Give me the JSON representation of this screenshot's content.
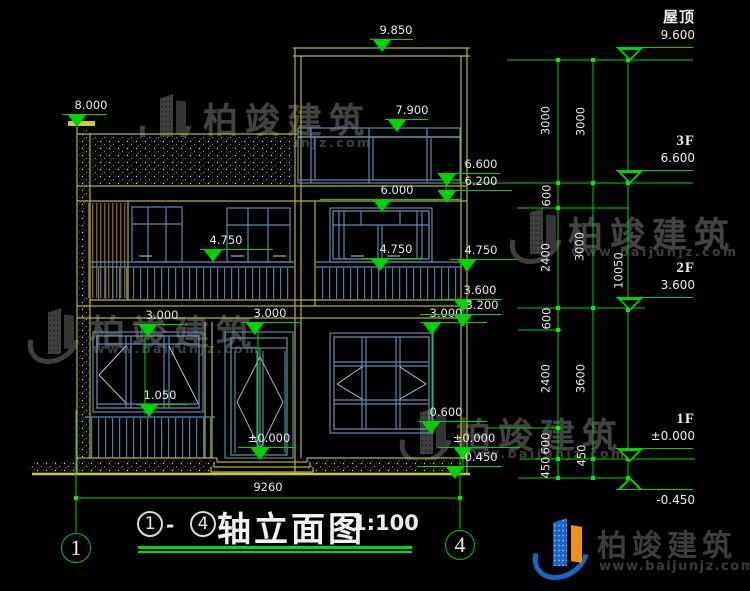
{
  "watermark": {
    "brand": "柏竣建筑",
    "url": "www.baijunjz.com"
  },
  "footer_logo": {
    "brand": "柏竣建筑",
    "url": "www.baijunjz.com"
  },
  "title": {
    "axis_start": "1",
    "dash": "-",
    "axis_end": "4",
    "name": "轴立面图",
    "scale": "1:100"
  },
  "axis_bubbles": [
    {
      "label": "1",
      "x": 76,
      "y": 548
    },
    {
      "label": "4",
      "x": 460,
      "y": 545
    }
  ],
  "width_dim": {
    "value": "9260",
    "x": 268,
    "y": 488
  },
  "elevation_marks": [
    {
      "value": "8.000",
      "tx": 91,
      "x1": 62,
      "x2": 107,
      "ly": 114,
      "mx": 77
    },
    {
      "value": "9.850",
      "tx": 396,
      "x1": 370,
      "x2": 413,
      "ly": 39,
      "mx": 382
    },
    {
      "value": "7.900",
      "tx": 412,
      "x1": 385,
      "x2": 428,
      "ly": 119,
      "mx": 397
    },
    {
      "value": "6.000",
      "tx": 397,
      "x1": 320,
      "x2": 462,
      "ly": 199,
      "mx": 382
    },
    {
      "value": "4.750",
      "tx": 226,
      "x1": 200,
      "x2": 273,
      "ly": 249,
      "mx": 213
    },
    {
      "value": "4.750",
      "tx": 396,
      "x1": 362,
      "x2": 422,
      "ly": 258,
      "mx": 380
    },
    {
      "value": "3.000",
      "tx": 162,
      "x1": 133,
      "x2": 187,
      "ly": 324,
      "mx": 148
    },
    {
      "value": "3.000",
      "tx": 270,
      "x1": 242,
      "x2": 300,
      "ly": 322,
      "mx": 255
    },
    {
      "value": "3.000",
      "tx": 446,
      "x1": 420,
      "x2": 487,
      "ly": 322,
      "mx": 432
    },
    {
      "value": "1.050",
      "tx": 160,
      "x1": 136,
      "x2": 187,
      "ly": 404,
      "mx": 149
    },
    {
      "value": "±0.000",
      "tx": 269,
      "x1": 238,
      "x2": 296,
      "ly": 447,
      "mx": 260
    },
    {
      "value": "0.600",
      "tx": 446,
      "x1": 418,
      "x2": 487,
      "ly": 421,
      "mx": 431
    },
    {
      "value": "6.600",
      "tx": 481,
      "x1": 438,
      "x2": 500,
      "ly": 173,
      "mx": 447
    },
    {
      "value": "6.200",
      "tx": 481,
      "x1": 438,
      "x2": 512,
      "ly": 190,
      "mx": 447
    },
    {
      "value": "4.750",
      "tx": 481,
      "x1": 450,
      "x2": 517,
      "ly": 259,
      "mx": 467
    },
    {
      "value": "3.600",
      "tx": 480,
      "x1": 438,
      "x2": 502,
      "ly": 299,
      "mx": 463
    },
    {
      "value": "3.200",
      "tx": 482,
      "x1": 420,
      "x2": 502,
      "ly": 314,
      "mx": 463
    },
    {
      "value": "±0.000",
      "tx": 474,
      "x1": 438,
      "x2": 520,
      "ly": 447,
      "mx": 463
    },
    {
      "value": "-0.450",
      "tx": 479,
      "x1": 417,
      "x2": 502,
      "ly": 466,
      "mx": 455
    }
  ],
  "floor_marks": [
    {
      "name": "屋顶",
      "value": "9.600",
      "ly": 47,
      "tipy": 60,
      "below": false
    },
    {
      "name": "3F",
      "value": "6.600",
      "ly": 170,
      "tipy": 183,
      "below": false
    },
    {
      "name": "2F",
      "value": "3.600",
      "ly": 297,
      "tipy": 310,
      "below": false
    },
    {
      "name": "1F",
      "value": "±0.000",
      "ly": 448,
      "tipy": 459,
      "below": false
    },
    {
      "name": "",
      "value": "-0.450",
      "ly": 489,
      "tipy": 477,
      "below": true
    }
  ],
  "dim_labels": [
    {
      "value": "3000",
      "x": 546,
      "y": 121
    },
    {
      "value": "600",
      "x": 547,
      "y": 196
    },
    {
      "value": "2400",
      "x": 546,
      "y": 258
    },
    {
      "value": "600",
      "x": 547,
      "y": 319
    },
    {
      "value": "2400",
      "x": 546,
      "y": 379
    },
    {
      "value": "600",
      "x": 546,
      "y": 444
    },
    {
      "value": "450",
      "x": 546,
      "y": 468
    },
    {
      "value": "3000",
      "x": 581,
      "y": 122
    },
    {
      "value": "3000",
      "x": 580,
      "y": 247
    },
    {
      "value": "3600",
      "x": 581,
      "y": 379
    },
    {
      "value": "450",
      "x": 582,
      "y": 456
    },
    {
      "value": "10050",
      "x": 619,
      "y": 271
    }
  ]
}
